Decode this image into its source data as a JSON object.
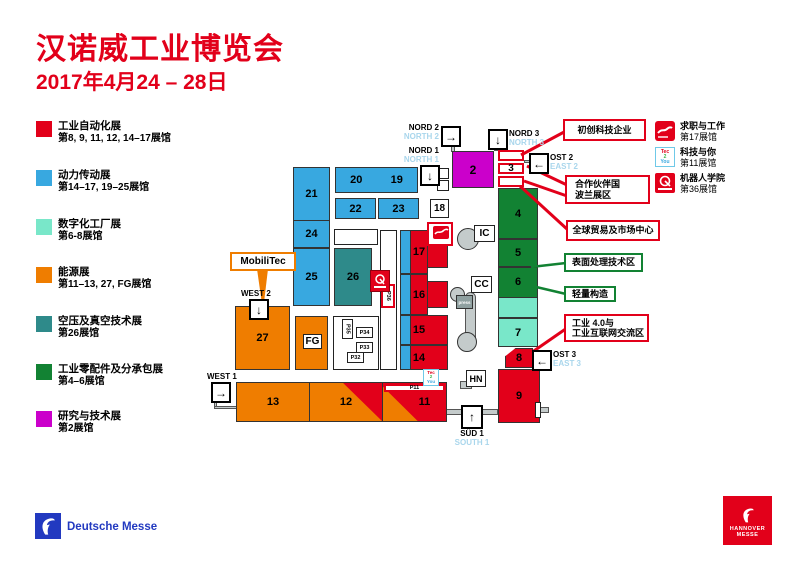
{
  "colors": {
    "red": "#e2001a",
    "blue": "#38a8e0",
    "mint": "#79e7c9",
    "teal": "#2e8a8a",
    "orange": "#ef7d00",
    "green": "#128233",
    "magenta": "#cb00cb",
    "entrance_en_label": "#a9d6ec",
    "walkway_gray": "#c4cbcb",
    "dm_blue": "#2239c0"
  },
  "header": {
    "title": "汉诺威工业博览会",
    "dates": "2017年4月24 – 28日"
  },
  "legend": [
    {
      "name": "工业自动化展",
      "halls": "第8, 9, 11, 12, 14–17展馆",
      "color": "#e2001a"
    },
    {
      "name": "动力传动展",
      "halls": "第14–17, 19–25展馆",
      "color": "#38a8e0"
    },
    {
      "name": "数字化工厂展",
      "halls": "第6-8展馆",
      "color": "#79e7c9"
    },
    {
      "name": "能源展",
      "halls": "第11–13, 27, FG展馆",
      "color": "#ef7d00"
    },
    {
      "name": "空压及真空技术展",
      "halls": "第26展馆",
      "color": "#2e8a8a"
    },
    {
      "name": "工业零配件及分承包展",
      "halls": "第4–6展馆",
      "color": "#128233"
    },
    {
      "name": "研究与技术展",
      "halls": "第2展馆",
      "color": "#cb00cb"
    }
  ],
  "side_legend": [
    {
      "icon": "job-and-career-icon",
      "name": "求职与工作",
      "halls": "第17展馆"
    },
    {
      "icon": "tec2you-icon",
      "name": "科技与你",
      "halls": "第11展馆"
    },
    {
      "icon": "robotation-academy-icon",
      "name": "机器人学院",
      "halls": "第36展馆"
    }
  ],
  "tec2you_icon": {
    "tec": "Tec",
    "two": "2",
    "you": "You"
  },
  "map": {
    "halls": {
      "h2": "2",
      "h3": "3",
      "h4": "4",
      "h5": "5",
      "h6": "6",
      "h7": "7",
      "h8": "8",
      "h9": "9",
      "h11": "11",
      "h12": "12",
      "h13": "13",
      "h14": "14",
      "h15": "15",
      "h16": "16",
      "h17": "17",
      "h18": "18",
      "h19": "19",
      "h20": "20",
      "h21": "21",
      "h22": "22",
      "h23": "23",
      "h24": "24",
      "h25": "25",
      "h26": "26",
      "h27": "27",
      "fg": "FG"
    },
    "pavilions": {
      "p11": "P11",
      "p32": "P32",
      "p33": "P33",
      "p34": "P34",
      "p35": "P35",
      "p36": "P36"
    },
    "facilities": {
      "ic": "IC",
      "cc": "CC",
      "hn": "HN",
      "press": "press"
    },
    "entrances": {
      "nord2": {
        "de": "NORD 2",
        "en": "NORTH 2",
        "arrow": "→"
      },
      "nord1": {
        "de": "NORD 1",
        "en": "NORTH 1",
        "arrow": "↓"
      },
      "nord3": {
        "de": "NORD 3",
        "en": "NORTH 3",
        "arrow": "↓"
      },
      "ost2": {
        "de": "OST 2",
        "en": "EAST 2",
        "arrow": "←"
      },
      "ost3": {
        "de": "OST 3",
        "en": "EAST 3",
        "arrow": "←"
      },
      "west2": {
        "de": "WEST 2",
        "en": "",
        "arrow": "↓"
      },
      "west1": {
        "de": "WEST 1",
        "en": "",
        "arrow": "→"
      },
      "sud1": {
        "de": "SÜD 1",
        "en": "SOUTH 1",
        "arrow": "↑"
      }
    },
    "callouts": {
      "startup": {
        "text": "初创科技企业"
      },
      "partner_country": {
        "line1": "合作伙伴国",
        "line2": "波兰展区"
      },
      "global_trade": {
        "text": "全球贸易及市场中心"
      },
      "surface_treatment": {
        "text": "表面处理技术区"
      },
      "lightweight": {
        "text": "轻量构造"
      },
      "industry40": {
        "line1": "工业 4.0与",
        "line2": "工业互联网交流区"
      }
    },
    "mobilitec": "MobiliTec"
  },
  "footer": {
    "deutsche_messe": "Deutsche Messe",
    "hannover_line1": "HANNOVER",
    "hannover_line2": "MESSE"
  }
}
